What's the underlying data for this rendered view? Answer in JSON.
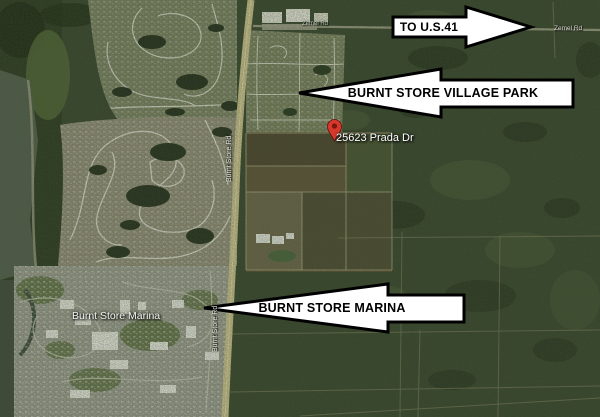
{
  "annotations": {
    "us41_arrow": "TO U.S.41",
    "village_park_arrow": "BURNT STORE VILLAGE PARK",
    "marina_arrow": "BURNT STORE MARINA"
  },
  "map_labels": {
    "address": "25623 Prada Dr",
    "marina_community": "Burnt Store Marina",
    "zemel_rd": "Zemel Rd",
    "zemel_rd_west": "Zemel Rd",
    "burnt_store_rd_north": "Burnt Store Rd",
    "burnt_store_rd_south": "Burnt Store Rd"
  },
  "marker": {
    "pin_color": "#d6392b"
  },
  "colors": {
    "arrow_fill": "#ffffff",
    "arrow_outline": "#000000",
    "label_text": "#ffffff",
    "wilderness_green": "#33402a",
    "road_tan": "#d9cb94"
  }
}
